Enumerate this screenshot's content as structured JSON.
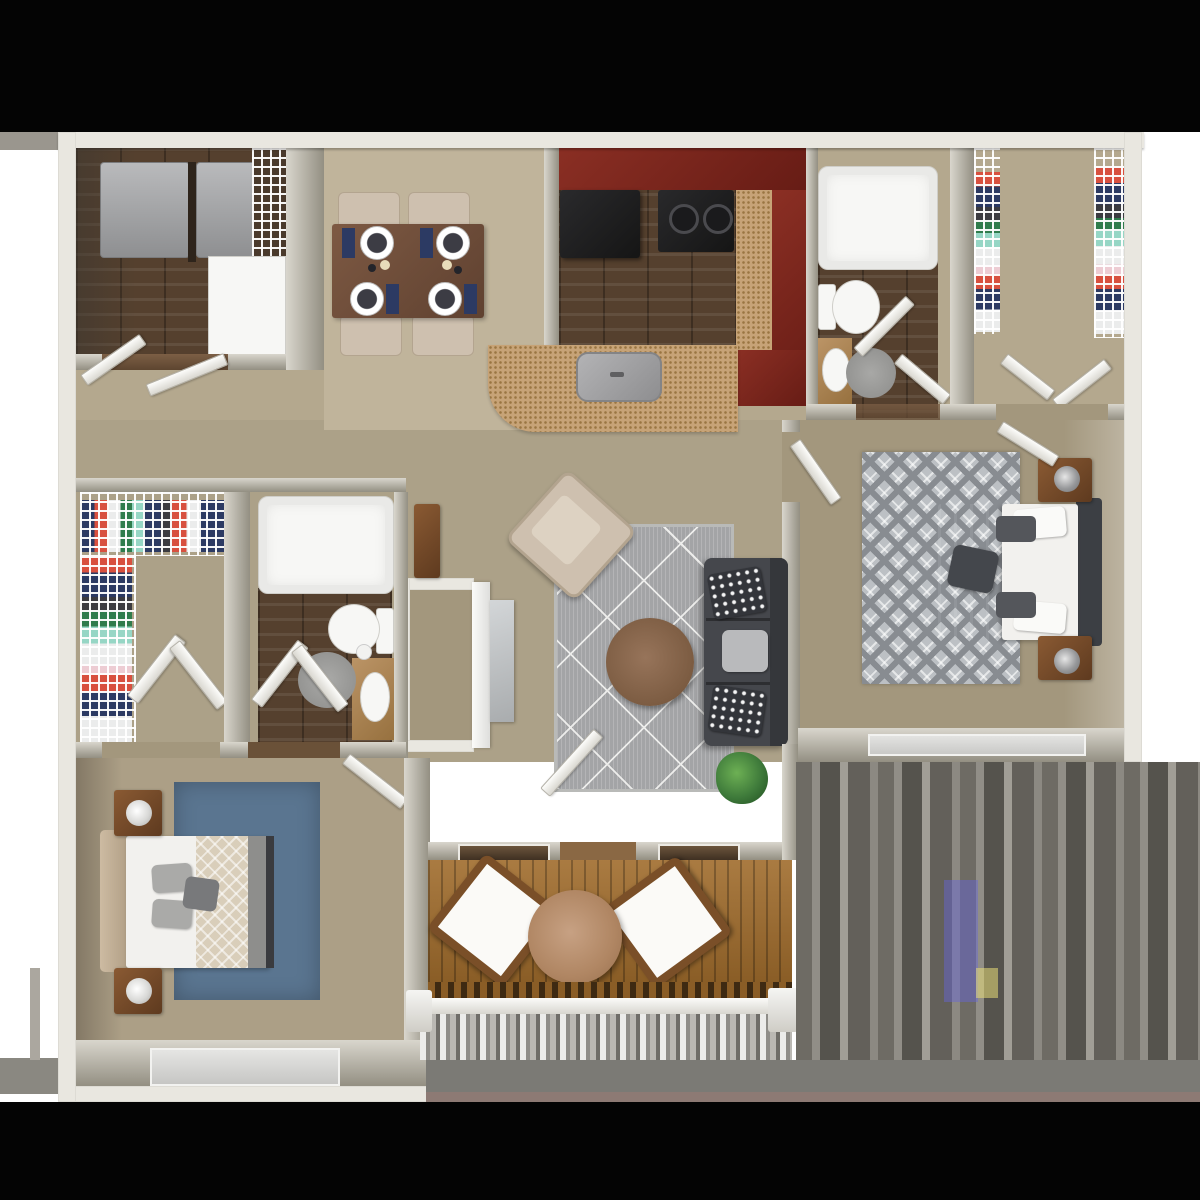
{
  "meta": {
    "title": "2 Bedroom / 2 Bathroom Apartment — 3D Top-Down Floor Plan",
    "description": "Photorealistic rendered floor plan with tan carpet, dark wood wet areas, cherry kitchen cabinets and a wood-deck balcony",
    "visible_text": ""
  },
  "palette": {
    "page_bg": "#ffffff",
    "bar": "#040404",
    "trim": "#e9e7e0",
    "wall_hi": "#d9d6cd",
    "wall_lo": "#938f82",
    "carpet": "#b4a88e",
    "carpet_light": "#c0b49b",
    "carpet_dark": "#a3977d",
    "wood_floor": "#55402e",
    "deck": "#a06c2c",
    "cab_red": "#8b2f24",
    "cab_red_dark": "#671c15",
    "counter": "#c7a377",
    "counter_dot": "#9a7542",
    "appliance_black": "#151515",
    "appliance_gray": "#a6a7a9",
    "white_fix": "#f7f7f5",
    "sofa": "#45474c",
    "sofa_dark": "#35373b",
    "rug_gray": "#a3a4a6",
    "rug_line": "#ececea",
    "rug_diamond": "#bcc0c4",
    "rug_diamond_dark": "#888c91",
    "rug_blue": "#5a7590",
    "wood_furn": "#8a5a33",
    "wood_furn_dark": "#5e3a1f",
    "bed_white": "#f2f1ee",
    "duvet": "#484b50",
    "head_dark": "#3c3f44",
    "beige": "#cec0af",
    "beige_dark": "#b3a48f",
    "marble": "#c2c5c7",
    "plant_green": "#3f7b3b",
    "c_red": "#d8503f",
    "c_navy": "#2c3a63",
    "c_white": "#ebecec",
    "c_green": "#2f7c4c",
    "c_teal": "#96d6c5",
    "c_black": "#3b3b40",
    "c_pink": "#edccd3",
    "smear_band": "#7b7a75",
    "smear_mauve": "#8d7a74"
  },
  "rooms": [
    {
      "name": "Laundry Room",
      "furniture": [
        "washer",
        "dryer",
        "wire shelf",
        "utility closet"
      ]
    },
    {
      "name": "Dining Area",
      "furniture": [
        "dining table",
        "4 chairs",
        "place settings"
      ]
    },
    {
      "name": "Kitchen",
      "furniture": [
        "refrigerator",
        "range",
        "sink",
        "cherry cabinets",
        "counter peninsula"
      ]
    },
    {
      "name": "Bathroom 1",
      "furniture": [
        "bathtub",
        "toilet",
        "vanity sink",
        "rug"
      ]
    },
    {
      "name": "Walk-in Closet 1",
      "furniture": [
        "wire shelving",
        "hanging clothes"
      ]
    },
    {
      "name": "Hallway",
      "furniture": [
        "linen cabinet",
        "storage nook"
      ]
    },
    {
      "name": "Living Room",
      "furniture": [
        "sofa",
        "coffee table",
        "armchair",
        "area rug",
        "plant",
        "media panel"
      ]
    },
    {
      "name": "Master Bedroom",
      "furniture": [
        "bed",
        "2 nightstands",
        "2 lamps",
        "diamond rug",
        "window"
      ]
    },
    {
      "name": "Bathroom 2",
      "furniture": [
        "bathtub",
        "toilet",
        "vanity sink",
        "rug"
      ]
    },
    {
      "name": "Walk-in Closet 2",
      "furniture": [
        "wire shelving",
        "hanging clothes"
      ]
    },
    {
      "name": "Bedroom 2",
      "furniture": [
        "bed",
        "2 nightstands",
        "2 lamps",
        "blue rug",
        "window"
      ]
    },
    {
      "name": "Balcony",
      "furniture": [
        "2 patio chairs",
        "round table",
        "wood deck",
        "railing"
      ]
    }
  ]
}
